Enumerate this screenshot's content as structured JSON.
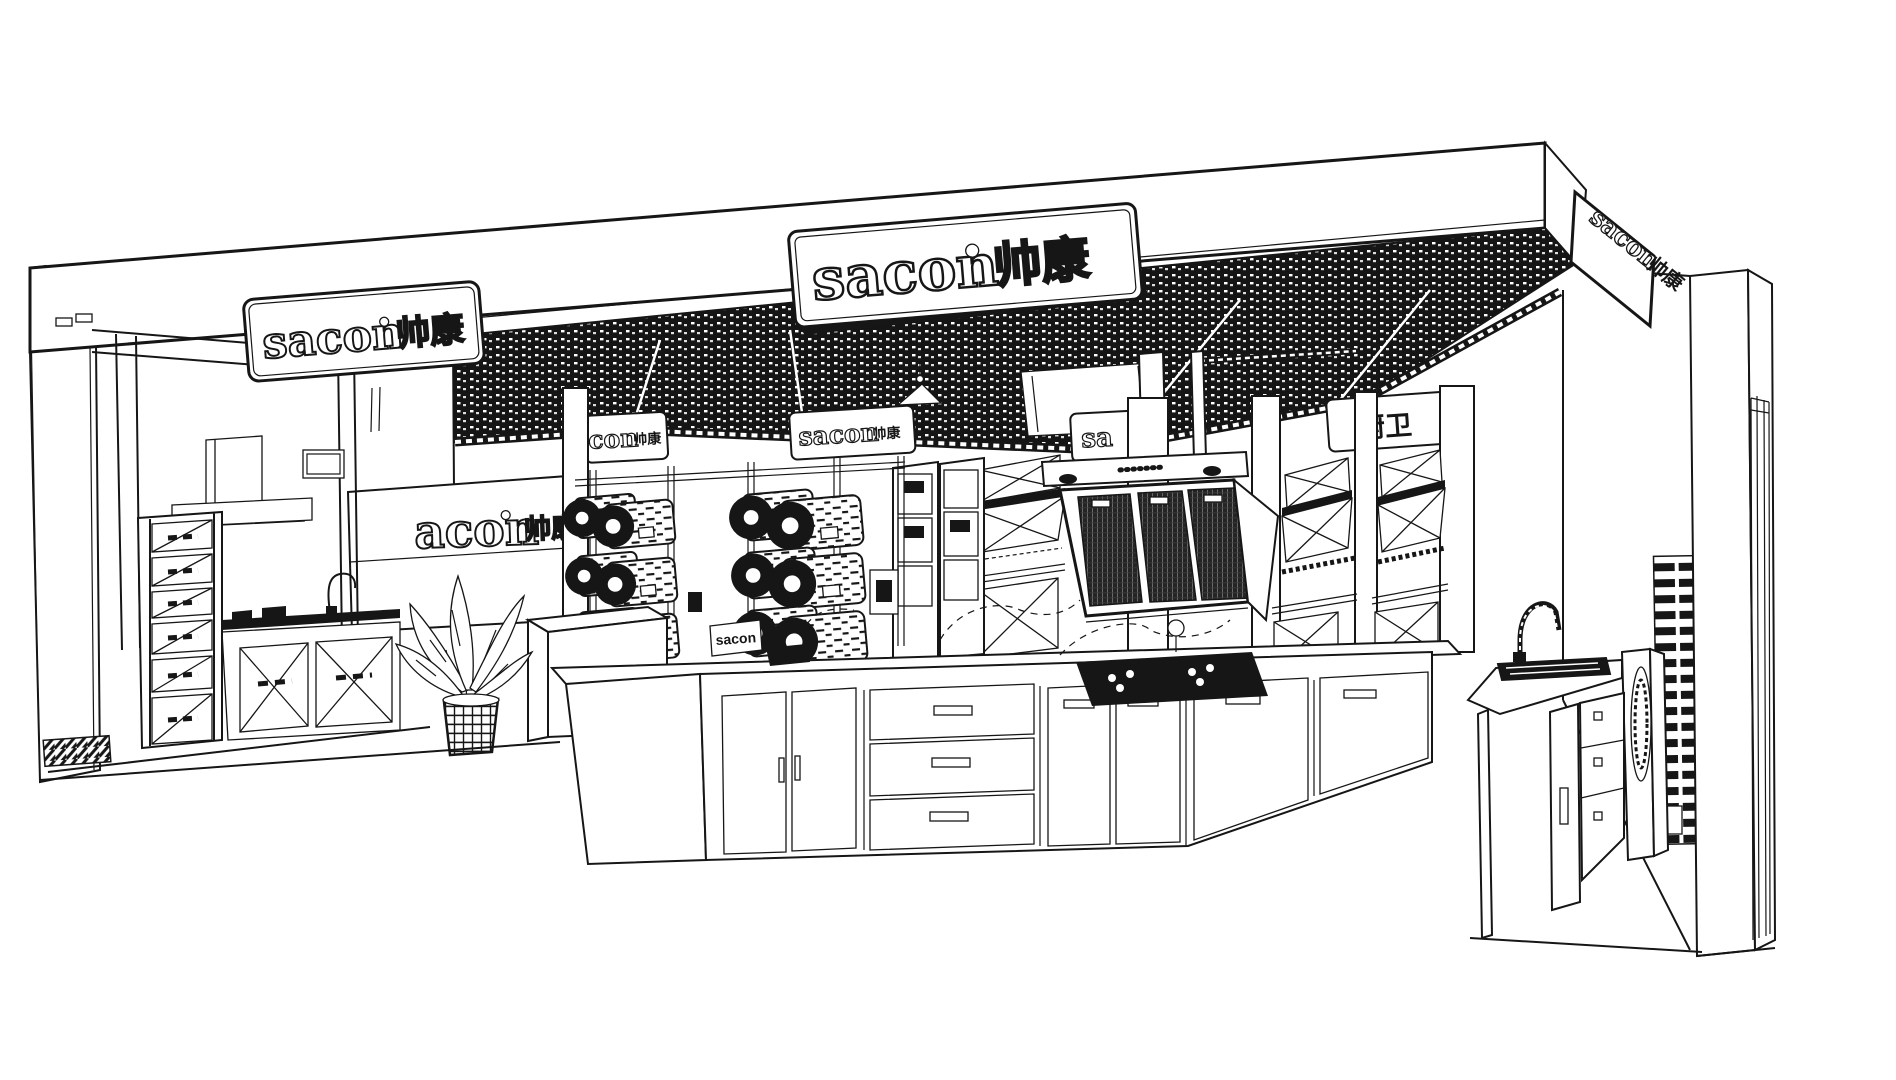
{
  "scene": {
    "description": "Black-and-white perspective line drawing of a Sacon (帅康) kitchen appliance showroom with signed fascia, black open-cell ceiling, range-hood displays, kitchen island and sink area",
    "style": "technical line-art sketch",
    "colors": {
      "ink": "#161616",
      "paper": "#ffffff"
    }
  },
  "brand": {
    "latin": "sacon",
    "cn": "帅康"
  },
  "signs": {
    "fascia_left": {
      "latin": "sacon",
      "cn": "帅康"
    },
    "fascia_center": {
      "latin": "sacon",
      "cn": "帅康"
    },
    "fascia_right": {
      "latin": "sacon",
      "cn": "帅康"
    },
    "logo_wall": {
      "latin_visible": "acon",
      "cn": "帅康"
    },
    "hanging": [
      {
        "latin_visible": "con",
        "cn": "帅康"
      },
      {
        "latin": "sacon",
        "cn": "帅康"
      },
      {
        "latin_visible": "sa"
      },
      {
        "cn_visible": "厨卫"
      }
    ],
    "island_logo": {
      "latin": "sacon"
    }
  }
}
